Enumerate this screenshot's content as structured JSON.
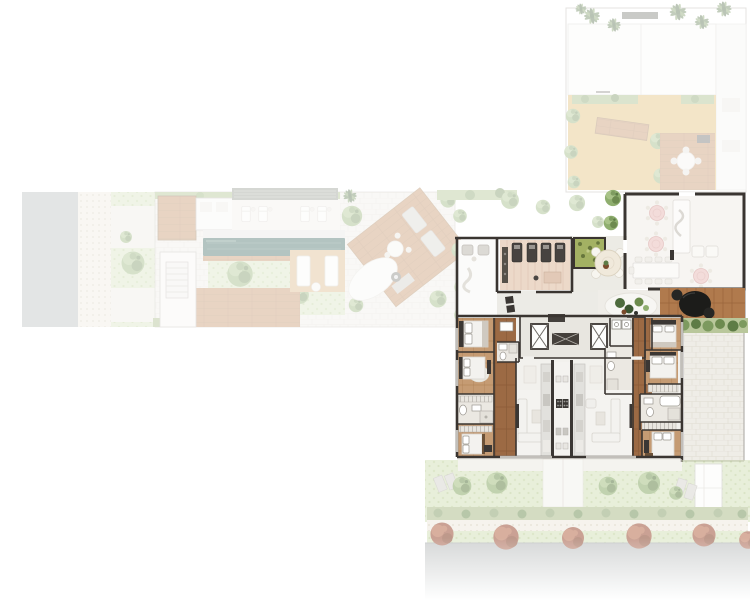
{
  "plan": {
    "background": "#ffffff",
    "fade": {
      "context": 0.36,
      "garden": 0.55
    },
    "colors": {
      "wall": "#3a3531",
      "road": "#b4b8b8",
      "pool": "#2f5e55",
      "pool_deck": "#e4e6e1",
      "sand": "#e0b96a",
      "roof": "#8d9288",
      "dining_floor": "#f7f5f2",
      "pink_table": "#f3dcda",
      "gym_floor": "#ecd9c9",
      "moss_planter": "#a3b163",
      "unit_floor": "#f2f1ed",
      "core_floor": "#e8e6e0",
      "black_table": "#1c1c1a",
      "white_room": "#fbfbfa",
      "hedge": "#7d9a5f",
      "lawn": "#d7e3bd",
      "wood_floor": "#9c6a44",
      "wood_deck": "#c08a5c",
      "stone": "#efede7",
      "red_tree": "#a0563d"
    },
    "regions": [
      "street-west",
      "sidewalk-west",
      "amenity-garden-wing",
      "lap-pool",
      "sun-lounger-deck",
      "pool-lawn",
      "diagonal-sun-deck",
      "reflecting-pond",
      "roof-terrace",
      "terrace-patio",
      "terrace-wood-deck",
      "private-dining-room",
      "outdoor-dining-deck",
      "gym",
      "lounge-room",
      "moss-planter",
      "elevator-core",
      "utility-room",
      "apartment-unit-west",
      "apartment-unit-east",
      "kitchen-core",
      "private-terrace-east",
      "rear-garden",
      "hedge-row",
      "street-south",
      "street-trees"
    ]
  }
}
